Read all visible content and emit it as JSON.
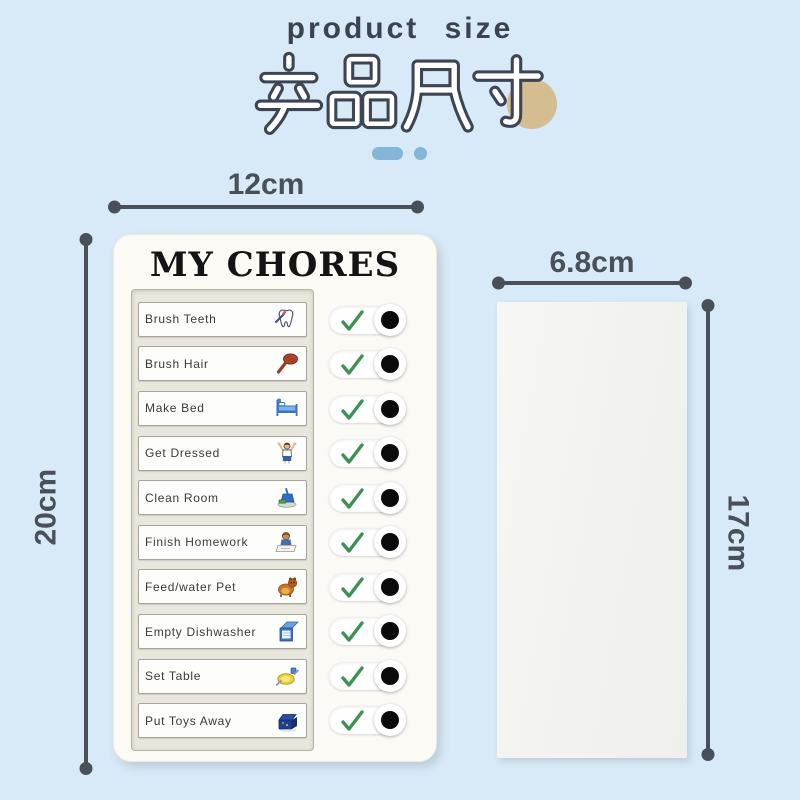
{
  "title": {
    "en": "product size",
    "zh": "产品尺寸"
  },
  "decor": {
    "dash": "rounded-dash",
    "dot": "round-dot",
    "circle": "tan-circle"
  },
  "colors": {
    "background": "#d8eaf7",
    "dimension": "#4a505a",
    "check": "#3e9152",
    "dash": "#84b6d8",
    "circle": "#d5bd92",
    "board": "#fbfaf5",
    "panel": "#e9e6dd",
    "slot": "#fdfdfb",
    "card": "#f2f2ef",
    "title_text": "#3b4351",
    "outline": "#3d4452"
  },
  "board": {
    "title": "MY CHORES",
    "chores": [
      {
        "label": "Brush Teeth",
        "icon": "tooth-icon",
        "checked": true
      },
      {
        "label": "Brush Hair",
        "icon": "hairbrush-icon",
        "checked": true
      },
      {
        "label": "Make Bed",
        "icon": "bed-icon",
        "checked": true
      },
      {
        "label": "Get Dressed",
        "icon": "child-dressing-icon",
        "checked": true
      },
      {
        "label": "Clean Room",
        "icon": "dustpan-icon",
        "checked": true
      },
      {
        "label": "Finish Homework",
        "icon": "child-writing-icon",
        "checked": true
      },
      {
        "label": "Feed/water Pet",
        "icon": "dog-icon",
        "checked": true
      },
      {
        "label": "Empty Dishwasher",
        "icon": "dishwasher-icon",
        "checked": true
      },
      {
        "label": "Set Table",
        "icon": "table-setting-icon",
        "checked": true
      },
      {
        "label": "Put Toys Away",
        "icon": "toy-box-icon",
        "checked": true
      }
    ]
  },
  "dimensions": {
    "board": {
      "width_label": "12cm",
      "height_label": "20cm"
    },
    "card": {
      "width_label": "6.8cm",
      "height_label": "17cm"
    }
  }
}
